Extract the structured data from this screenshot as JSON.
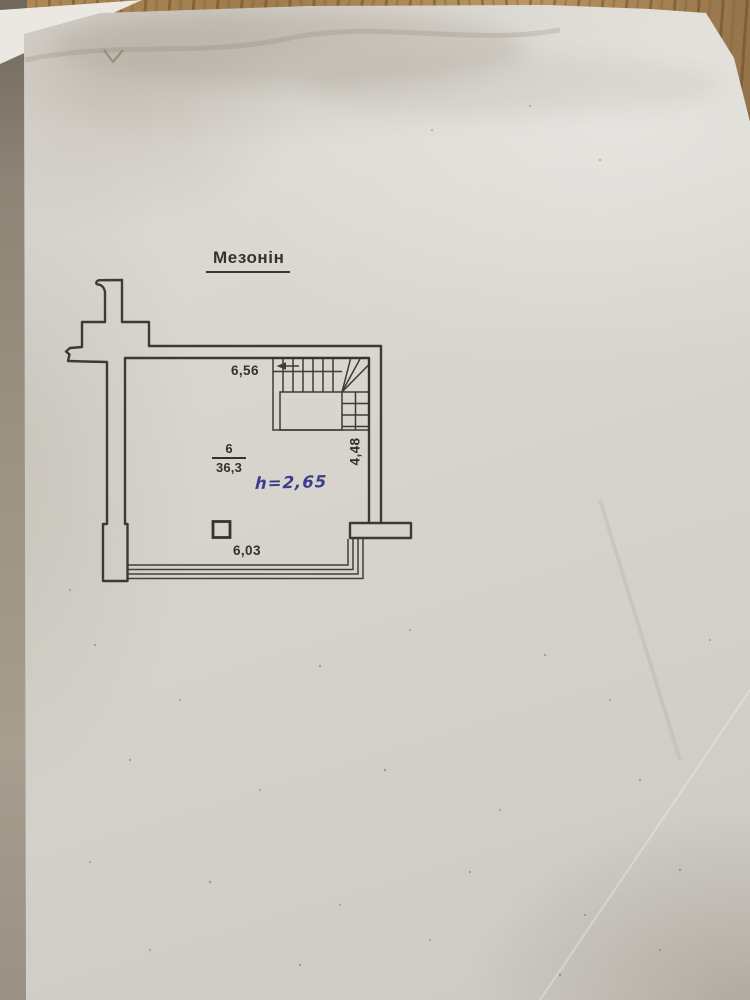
{
  "photo": {
    "paper_color": "#d7d4cd",
    "table_wood_color": "#ad8655",
    "drawing_line_color": "#2f2e2a",
    "handwriting_ink_color": "#3a3d8e"
  },
  "plan": {
    "title": "Мезонін",
    "room": {
      "number": "6",
      "area": "36,3"
    },
    "height_note": "h=2,65",
    "dimensions": {
      "top": "6,56",
      "right": "4,48",
      "bottom": "6,03"
    }
  }
}
